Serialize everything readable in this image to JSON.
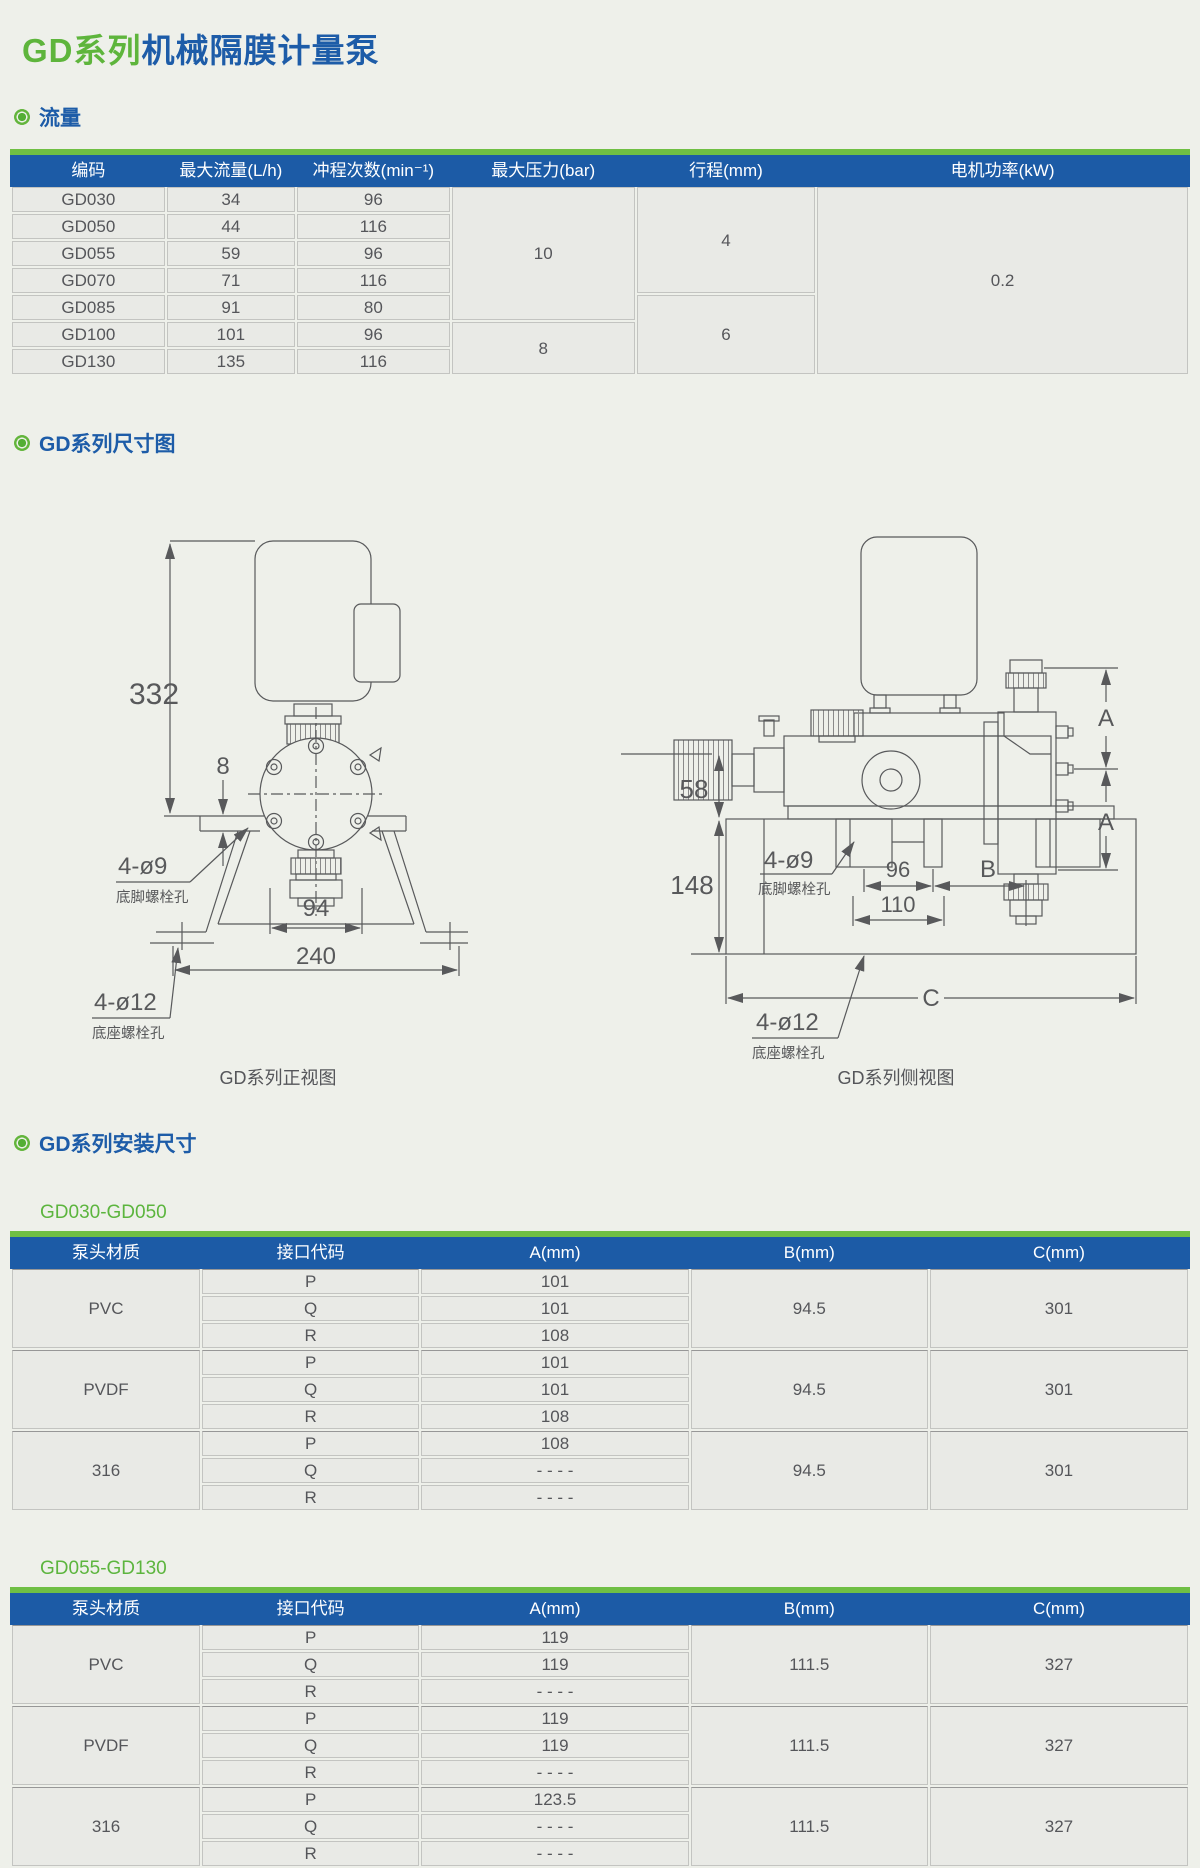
{
  "colors": {
    "accent_green": "#6fbf44",
    "header_blue": "#1c5ba6",
    "title_blue": "#1d5ca8",
    "title_green": "#5eb53c",
    "text_gray": "#58595b"
  },
  "page": {
    "title_highlight": "GD系列",
    "title_rest": "机械隔膜计量泵"
  },
  "sections": {
    "flow": "流量",
    "dimensions": "GD系列尺寸图",
    "install": "GD系列安装尺寸"
  },
  "flow_table": {
    "headers": [
      "编码",
      "最大流量(L/h)",
      "冲程次数(min⁻¹)",
      "最大压力(bar)",
      "行程(mm)",
      "电机功率(kW)"
    ],
    "rows": [
      [
        "GD030",
        "34",
        "96"
      ],
      [
        "GD050",
        "44",
        "116"
      ],
      [
        "GD055",
        "59",
        "96"
      ],
      [
        "GD070",
        "71",
        "116"
      ],
      [
        "GD085",
        "91",
        "80"
      ],
      [
        "GD100",
        "101",
        "96"
      ],
      [
        "GD130",
        "135",
        "116"
      ]
    ],
    "pressure_groups": [
      {
        "value": "10",
        "span": 5
      },
      {
        "value": "8",
        "span": 2
      }
    ],
    "stroke_groups": [
      {
        "value": "4",
        "span": 4
      },
      {
        "value": "6",
        "span": 3
      }
    ],
    "power": "0.2"
  },
  "drawings": {
    "front": {
      "caption": "GD系列正视图",
      "height": "332",
      "plate_thickness": "8",
      "inner_width": "94",
      "outer_width": "240",
      "foot_hole": "4-ø9",
      "foot_hole_note": "底脚螺栓孔",
      "base_hole": "4-ø12",
      "base_hole_note": "底座螺栓孔"
    },
    "side": {
      "caption": "GD系列侧视图",
      "h_upper": "58",
      "h_lower": "148",
      "w_inner": "96",
      "w_mid": "110",
      "dim_a": "A",
      "dim_b": "B",
      "dim_c": "C",
      "foot_hole": "4-ø9",
      "foot_hole_note": "底脚螺栓孔",
      "base_hole": "4-ø12",
      "base_hole_note": "底座螺栓孔"
    }
  },
  "install_tables": [
    {
      "range_label": "GD030-GD050",
      "headers": [
        "泵头材质",
        "接口代码",
        "A(mm)",
        "B(mm)",
        "C(mm)"
      ],
      "groups": [
        {
          "material": "PVC",
          "rows": [
            [
              "P",
              "101"
            ],
            [
              "Q",
              "101"
            ],
            [
              "R",
              "108"
            ]
          ],
          "b": "94.5",
          "c": "301"
        },
        {
          "material": "PVDF",
          "rows": [
            [
              "P",
              "101"
            ],
            [
              "Q",
              "101"
            ],
            [
              "R",
              "108"
            ]
          ],
          "b": "94.5",
          "c": "301"
        },
        {
          "material": "316",
          "rows": [
            [
              "P",
              "108"
            ],
            [
              "Q",
              "- - - -"
            ],
            [
              "R",
              "- - - -"
            ]
          ],
          "b": "94.5",
          "c": "301"
        }
      ]
    },
    {
      "range_label": "GD055-GD130",
      "headers": [
        "泵头材质",
        "接口代码",
        "A(mm)",
        "B(mm)",
        "C(mm)"
      ],
      "groups": [
        {
          "material": "PVC",
          "rows": [
            [
              "P",
              "119"
            ],
            [
              "Q",
              "119"
            ],
            [
              "R",
              "- - - -"
            ]
          ],
          "b": "111.5",
          "c": "327"
        },
        {
          "material": "PVDF",
          "rows": [
            [
              "P",
              "119"
            ],
            [
              "Q",
              "119"
            ],
            [
              "R",
              "- - - -"
            ]
          ],
          "b": "111.5",
          "c": "327"
        },
        {
          "material": "316",
          "rows": [
            [
              "P",
              "123.5"
            ],
            [
              "Q",
              "- - - -"
            ],
            [
              "R",
              "- - - -"
            ]
          ],
          "b": "111.5",
          "c": "327"
        }
      ]
    }
  ]
}
